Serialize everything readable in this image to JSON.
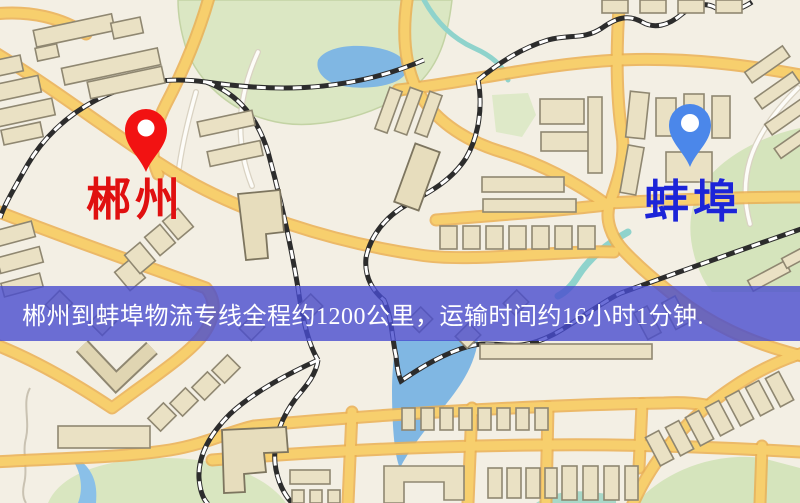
{
  "map": {
    "kind": "logistics-route-map",
    "origin": {
      "name": "郴州",
      "marker": "red-pin",
      "marker_color": "#f21212",
      "label_color": "#e01010"
    },
    "destination": {
      "name": "蚌埠",
      "marker": "blue-pin",
      "marker_color": "#4b87ea",
      "label_color": "#1c24d8"
    },
    "banner": {
      "text": "郴州到蚌埠物流专线全程约1200公里，运输时间约16小时1分钟.",
      "distance_text": "约1200公里",
      "duration_text": "约16小时1分钟",
      "bg_color": "#484cce",
      "text_color": "#ffffff"
    },
    "legend_colors": {
      "background": "#f3efe4",
      "road_major": "#f7cf6d",
      "road_casing": "#eaaf52",
      "road_minor": "#fdfcf8",
      "railway": "#2c2c2c",
      "park": "#dbe7c3",
      "water": "#80b7e3",
      "stream": "#8fd3cc",
      "building": "#eae1c4",
      "building_outline": "#8f8771"
    }
  }
}
